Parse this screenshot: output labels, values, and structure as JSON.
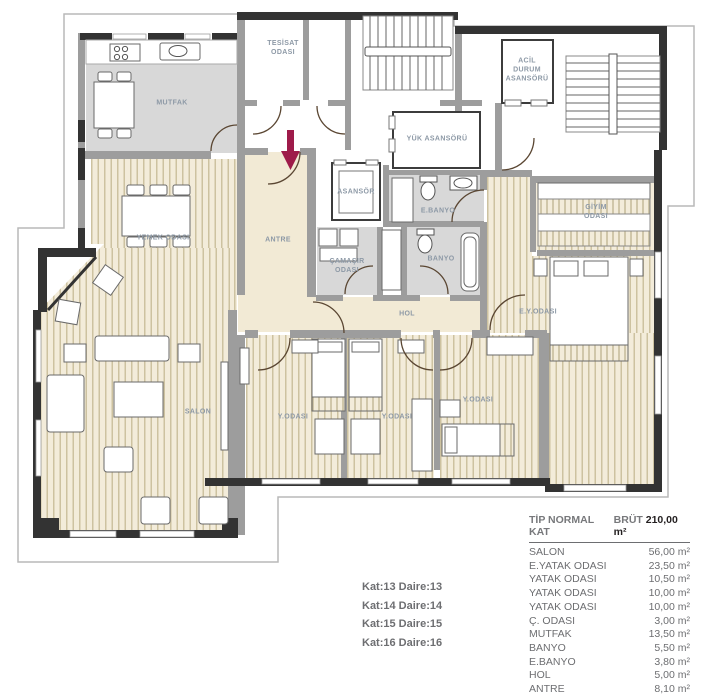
{
  "plan": {
    "colors": {
      "arrow": "#9e1b4a",
      "floor_wood": "#f3ecda",
      "floor_service": "#d8d8d8",
      "label": "#8d99a6",
      "wall_dark": "#333333",
      "wall_gray": "#9d9d9d"
    },
    "entrance_arrow_direction": "down",
    "rooms": {
      "mutfak": "MUTFAK",
      "tesisat": "TESİSAT\nODASI",
      "acil": "ACİL\nDURUM\nASANSÖRÜ",
      "yuk": "YÜK ASANSÖRÜ",
      "asansor": "ASANSÖR",
      "ebanyo": "E.BANYO",
      "antre": "ANTRE",
      "camasir": "ÇAMAŞIR\nODASI",
      "banyo": "BANYO",
      "hol": "HOL",
      "yemek": "YEMEK ODASI",
      "salon": "SALON",
      "giyim": "GİYİM\nODASI",
      "eyodasi": "E.Y.ODASI",
      "yodasi1": "Y.ODASI",
      "yodasi2": "Y.ODASI",
      "yodasi3": "Y.ODASI"
    }
  },
  "units": {
    "lines": [
      "Kat:13 Daire:13",
      "Kat:14 Daire:14",
      "Kat:15 Daire:15",
      "Kat:16 Daire:16"
    ]
  },
  "legend": {
    "type_label": "TİP NORMAL KAT",
    "gross_label": "BRÜT",
    "gross_value": "210,00 m²",
    "rows": [
      {
        "name": "SALON",
        "area": "56,00 m²"
      },
      {
        "name": "E.YATAK ODASI",
        "area": "23,50 m²"
      },
      {
        "name": "YATAK ODASI",
        "area": "10,50 m²"
      },
      {
        "name": "YATAK ODASI",
        "area": "10,00 m²"
      },
      {
        "name": "YATAK ODASI",
        "area": "10,00 m²"
      },
      {
        "name": "Ç. ODASI",
        "area": "3,00 m²"
      },
      {
        "name": "MUTFAK",
        "area": "13,50 m²"
      },
      {
        "name": "BANYO",
        "area": "5,50 m²"
      },
      {
        "name": "E.BANYO",
        "area": "3,80 m²"
      },
      {
        "name": "HOL",
        "area": "5,00 m²"
      },
      {
        "name": "ANTRE",
        "area": "8,10 m²"
      }
    ]
  }
}
